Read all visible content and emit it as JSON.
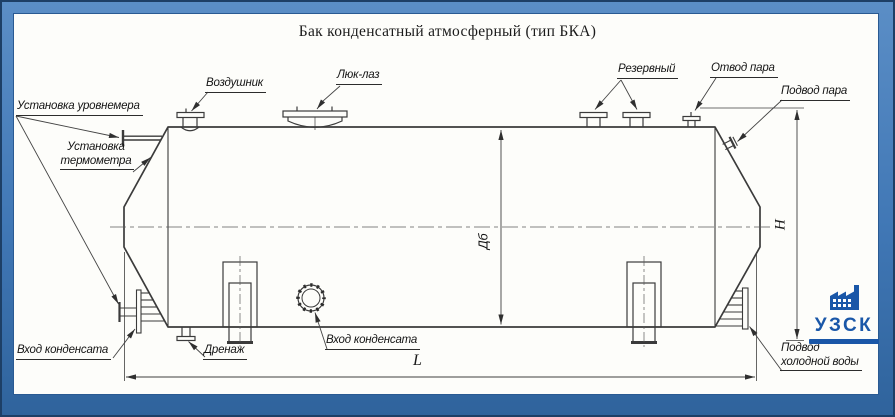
{
  "title": "Бак конденсатный атмосферный (тип БКА)",
  "labels": {
    "level_gauge": "Установка уровнемера",
    "thermometer_line1": "Установка",
    "thermometer_line2": "термометра",
    "air_vent": "Воздушник",
    "manhole": "Люк-лаз",
    "reserve": "Резервный",
    "steam_outlet": "Отвод пара",
    "steam_inlet": "Подвод пара",
    "condensate_inlet_left": "Вход конденсата",
    "drain": "Дренаж",
    "condensate_inlet_shell": "Вход конденсата",
    "cold_water_line1": "Подвод",
    "cold_water_line2": "холодной воды"
  },
  "dimensions": {
    "length": "L",
    "diameter": "Дб",
    "height": "H"
  },
  "logo": {
    "text": "УЗСК",
    "icon": "factory-icon",
    "accent_color": "#1a57a8"
  },
  "frame_color": "#4077b5",
  "line_color": "#3b3b3b"
}
